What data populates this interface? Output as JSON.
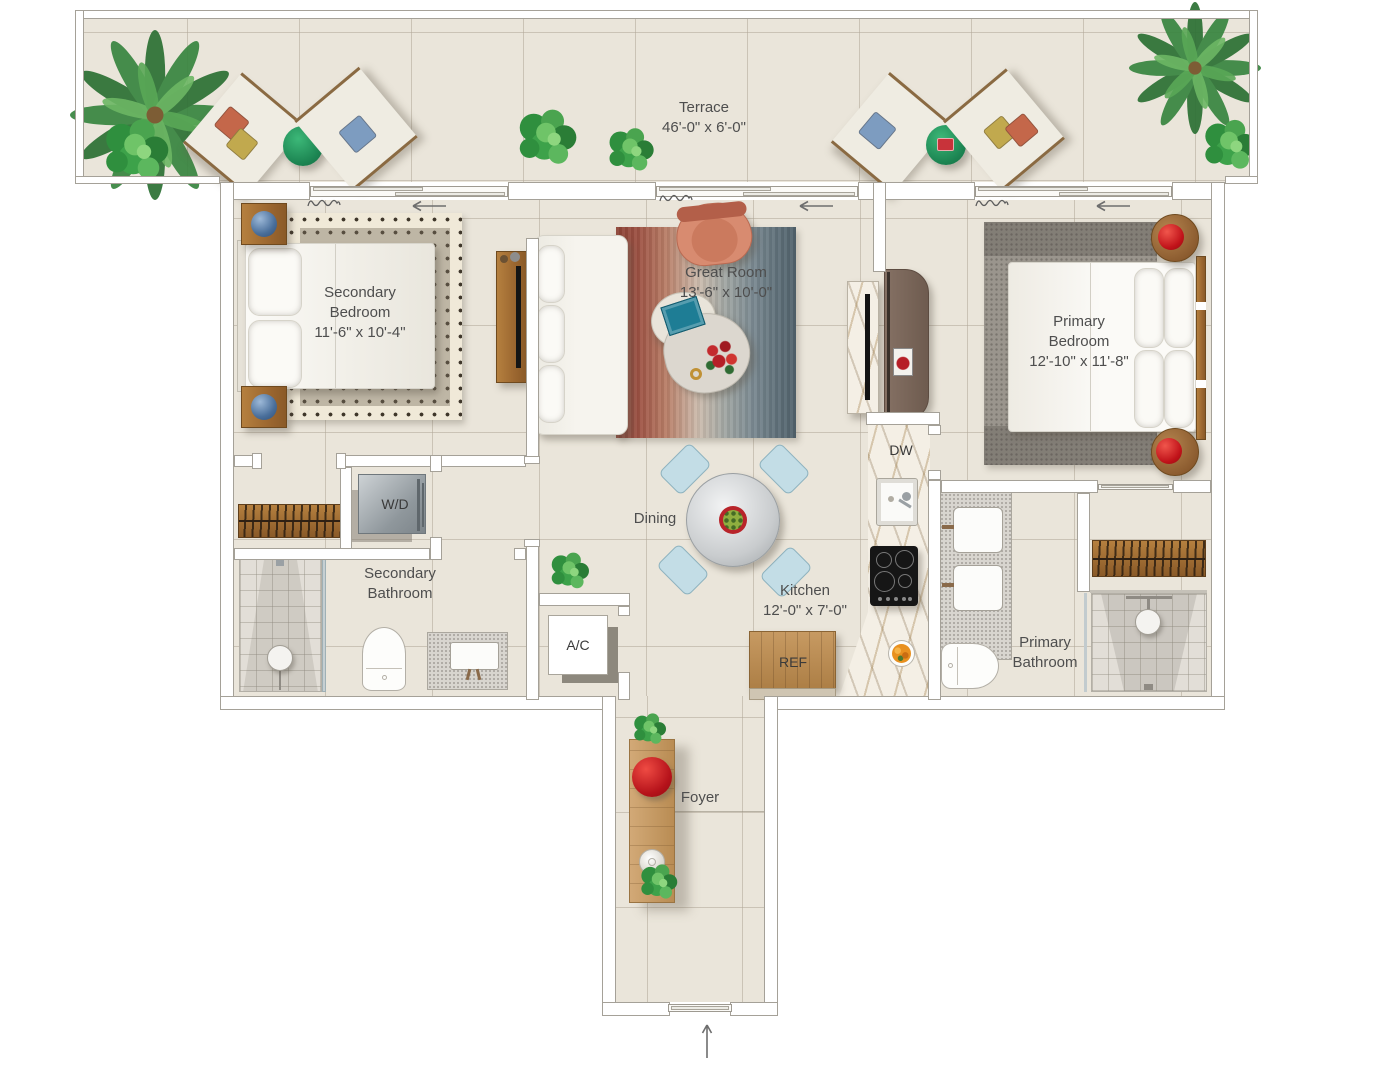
{
  "plan_title": "Two-bedroom residence floor plan",
  "rooms": {
    "terrace": {
      "lines": [
        "Terrace",
        "46'-0\" x 6'-0\""
      ]
    },
    "secondary_bedroom": {
      "lines": [
        "Secondary",
        "Bedroom",
        "11'-6\" x 10'-4\""
      ]
    },
    "great_room": {
      "lines": [
        "Great Room",
        "13'-6\" x 10'-0\""
      ]
    },
    "primary_bedroom": {
      "lines": [
        "Primary",
        "Bedroom",
        "12'-10\" x 11'-8\""
      ]
    },
    "dining": {
      "lines": [
        "Dining"
      ]
    },
    "kitchen": {
      "lines": [
        "Kitchen",
        "12'-0\" x 7'-0\""
      ]
    },
    "secondary_bathroom": {
      "lines": [
        "Secondary",
        "Bathroom"
      ]
    },
    "primary_bathroom": {
      "lines": [
        "Primary",
        "Bathroom"
      ]
    },
    "foyer": {
      "lines": [
        "Foyer"
      ]
    }
  },
  "appliances": {
    "washer_dryer": "W/D",
    "dishwasher": "DW",
    "air_conditioner": "A/C",
    "refrigerator": "REF"
  },
  "colors": {
    "floor": "#eae5da",
    "tile_line": "#b0a898",
    "wall_outline": "#a5a198",
    "label_text": "#4e4e4e",
    "wood": "#a9713a",
    "rug_rust": "#8d4437",
    "rug_blue": "#51626c",
    "accent_red": "#c01219",
    "accent_green": "#1d8653",
    "lamp_blue": "#4a6f9b",
    "dining_chair_blue": "#c3dde6",
    "armchair_salmon": "#d88b70"
  }
}
